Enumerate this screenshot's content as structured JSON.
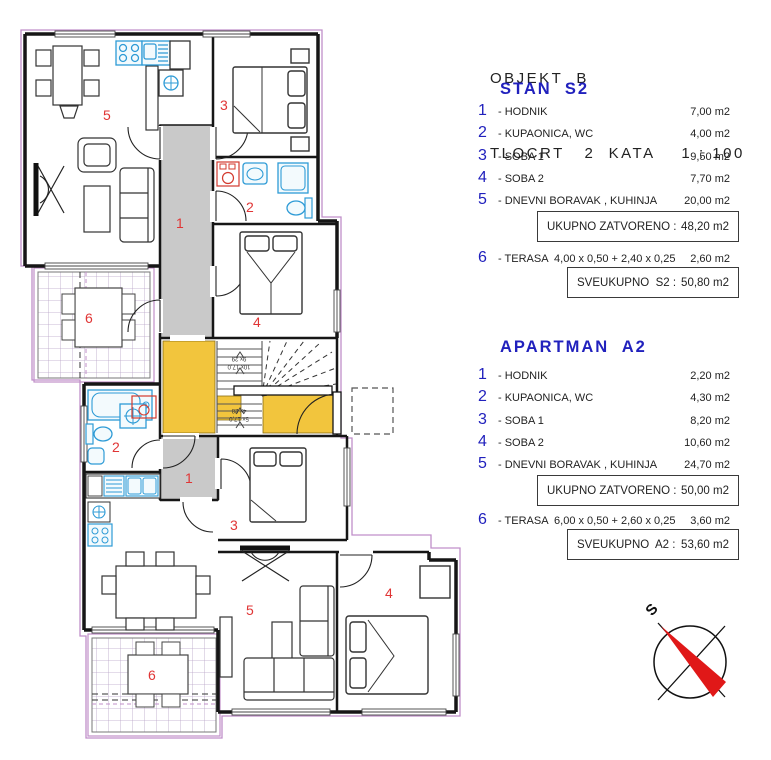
{
  "header": {
    "line1": "OBJEKT  B",
    "line2": "TLOCRT   2  KATA    1 : 100"
  },
  "sections": [
    {
      "title": "STAN  S2",
      "items": [
        {
          "num": "1",
          "label": "- HODNIK",
          "value": "7,00 m2"
        },
        {
          "num": "2",
          "label": "- KUPAONICA, WC",
          "value": "4,00 m2"
        },
        {
          "num": "3",
          "label": "- SOBA 1",
          "value": "9,50 m2"
        },
        {
          "num": "4",
          "label": "- SOBA 2",
          "value": "7,70 m2"
        },
        {
          "num": "5",
          "label": "- DNEVNI BORAVAK , KUHINJA",
          "value": "20,00 m2"
        }
      ],
      "subtotal": {
        "label": "UKUPNO ZATVORENO :",
        "value": "48,20 m2"
      },
      "terrace": {
        "num": "6",
        "label": "- TERASA  4,00 x 0,50 + 2,40 x 0,25",
        "value": "2,60 m2"
      },
      "total": {
        "label": "SVEUKUPNO  S2 :",
        "value": "50,80 m2"
      }
    },
    {
      "title": "APARTMAN  A2",
      "items": [
        {
          "num": "1",
          "label": "- HODNIK",
          "value": "2,20 m2"
        },
        {
          "num": "2",
          "label": "- KUPAONICA, WC",
          "value": "4,30 m2"
        },
        {
          "num": "3",
          "label": "- SOBA 1",
          "value": "8,20 m2"
        },
        {
          "num": "4",
          "label": "- SOBA 2",
          "value": "10,60 m2"
        },
        {
          "num": "5",
          "label": "- DNEVNI BORAVAK , KUHINJA",
          "value": "24,70 m2"
        }
      ],
      "subtotal": {
        "label": "UKUPNO ZATVORENO :",
        "value": "50,00 m2"
      },
      "terrace": {
        "num": "6",
        "label": "- TERASA  6,00 x 0,50 + 2,60 x 0,25",
        "value": "3,60 m2"
      },
      "total": {
        "label": "SVEUKUPNO  A2 :",
        "value": "53,60 m2"
      }
    }
  ],
  "plan": {
    "s2_labels": {
      "living": "5",
      "hall": "1",
      "soba1": "3",
      "bath": "2",
      "soba2": "4",
      "terrace": "6"
    },
    "a2_labels": {
      "bath": "2",
      "hall": "1",
      "soba1": "3",
      "living": "5",
      "soba2": "4",
      "terrace": "6"
    },
    "stairs": {
      "upper_line1": "10x 17,0",
      "upper_line2": "9x 29",
      "lower_line1": "5x 17,0",
      "lower_line2": "4x 28"
    },
    "compass_label": "S"
  },
  "colors": {
    "accent_blue": "#2121bd",
    "room_number_red": "#e03535",
    "stair_yellow": "#f2c53d",
    "fixture_blue": "#2e9bd6",
    "boundary_purple": "#c08fc9",
    "corridor_gray": "#c9c9c9"
  }
}
